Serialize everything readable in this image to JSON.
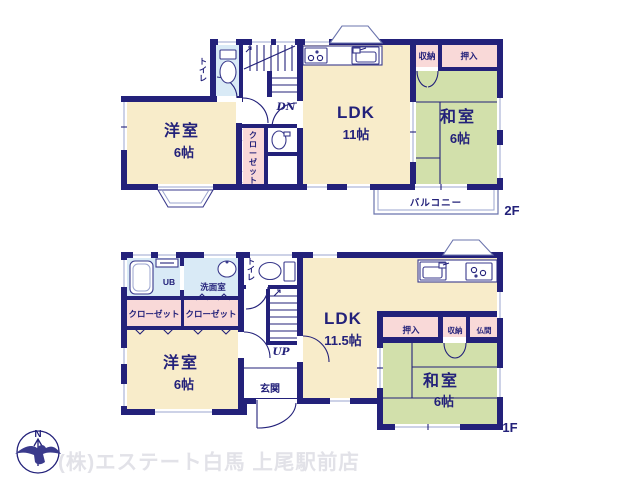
{
  "colors": {
    "wall_navy": "#23217a",
    "room_cream": "#f8ecca",
    "tatami_green": "#d2e0ab",
    "closet_pink": "#f9d9d8",
    "wet_area_blue": "#d9eaf6",
    "label_navy": "#23217a",
    "watermark_gray": "#e2e2e8"
  },
  "floor2": {
    "label": "2F",
    "toilet": "トイレ",
    "stairs": "DN",
    "yoshitsu_name": "洋室",
    "yoshitsu_size": "6帖",
    "closet": "クローゼット",
    "ldk_name": "LDK",
    "ldk_size": "11帖",
    "shuno": "収納",
    "oshiire": "押入",
    "washitsu_name": "和室",
    "washitsu_size": "6帖",
    "balcony": "バルコニー"
  },
  "floor1": {
    "label": "1F",
    "ub": "UB",
    "senmenshitsu": "洗面室",
    "toilet": "トイレ",
    "closet_left": "クローゼット",
    "closet_right": "クローゼット",
    "yoshitsu_name": "洋室",
    "yoshitsu_size": "6帖",
    "stairs": "UP",
    "genkan": "玄関",
    "ldk_name": "LDK",
    "ldk_size": "11.5帖",
    "oshiire": "押入",
    "shuno": "収納",
    "butsuma": "仏間",
    "washitsu_name": "和室",
    "washitsu_size": "6帖"
  },
  "footer": {
    "company": "(株)エステート白馬 上尾駅前店",
    "compass_north": "N"
  }
}
